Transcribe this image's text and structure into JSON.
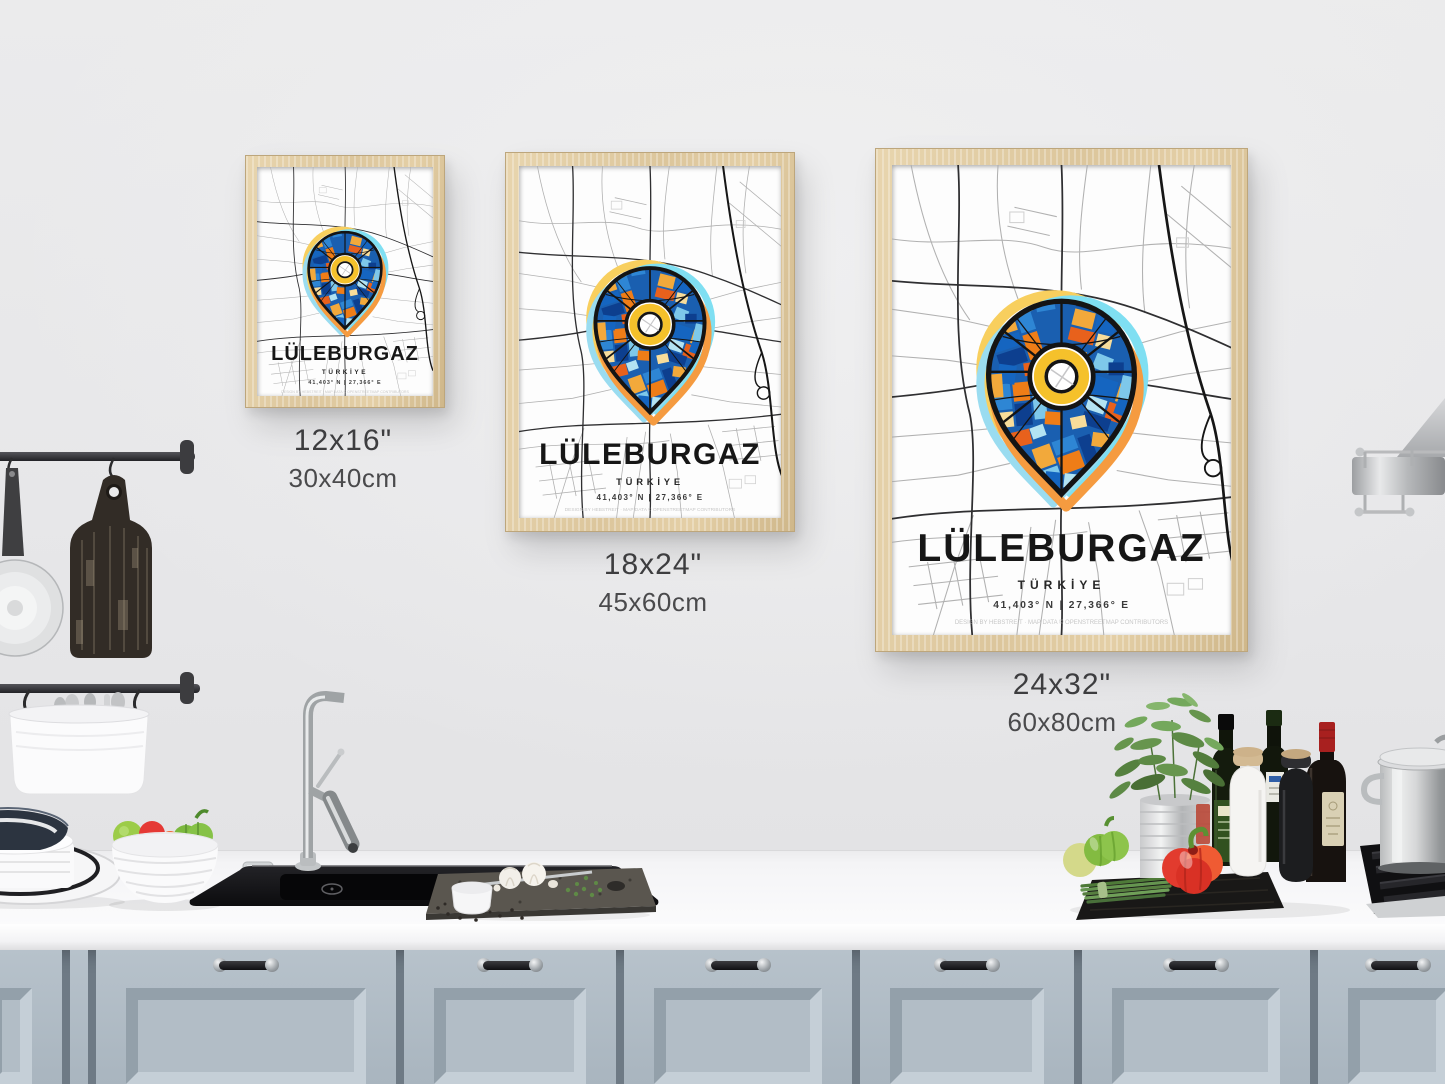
{
  "poster_design": {
    "city": "LÜLEBURGAZ",
    "country": "TÜRKİYE",
    "coordinates": "41,403° N | 27,366° E",
    "credit": "DESIGN BY HEBSTREIT · MAP DATA © OPENSTREETMAP CONTRIBUTORS"
  },
  "size_labels": [
    {
      "poster": "small",
      "inches": "12x16\"",
      "cm": "30x40cm"
    },
    {
      "poster": "medium",
      "inches": "18x24\"",
      "cm": "45x60cm"
    },
    {
      "poster": "large",
      "inches": "24x32\"",
      "cm": "60x80cm"
    }
  ],
  "palette": {
    "wall": "#e9e9ea",
    "frame_wood": "#ddc69d",
    "cabinet": "#aeb9c2",
    "pin_outline": "#141414",
    "halo_yellow": "#f8cf5e",
    "halo_cyan": "#7fdff2",
    "halo_lightblue": "#9adcf0",
    "halo_orange": "#f59b40",
    "ring_yellow": "#f5c12b",
    "mosaic_blues": [
      "#0d3f8f",
      "#1565c0",
      "#2e86d4",
      "#7ec8ea",
      "#b3e3f2"
    ],
    "mosaic_warm": [
      "#ef7d17",
      "#e8611c",
      "#f2a93b",
      "#f7dc9a"
    ]
  },
  "kitchen": {
    "items": [
      "hanging rail",
      "frying pan",
      "rustic wooden cutting board",
      "utensil holder with cutlery",
      "stacked plates",
      "fruit bowl with tomatoes and peppers",
      "black sink",
      "chrome faucet",
      "stone board with garlic and herbs",
      "herb plant in tin pot",
      "olive oil bottles",
      "salt grinder",
      "pepper grinder",
      "wine bottle",
      "red bell pepper",
      "green bell pepper",
      "spring onions",
      "dark cutting board",
      "gas hob",
      "steel stock pot",
      "range hood",
      "blue-grey cabinet doors"
    ]
  }
}
